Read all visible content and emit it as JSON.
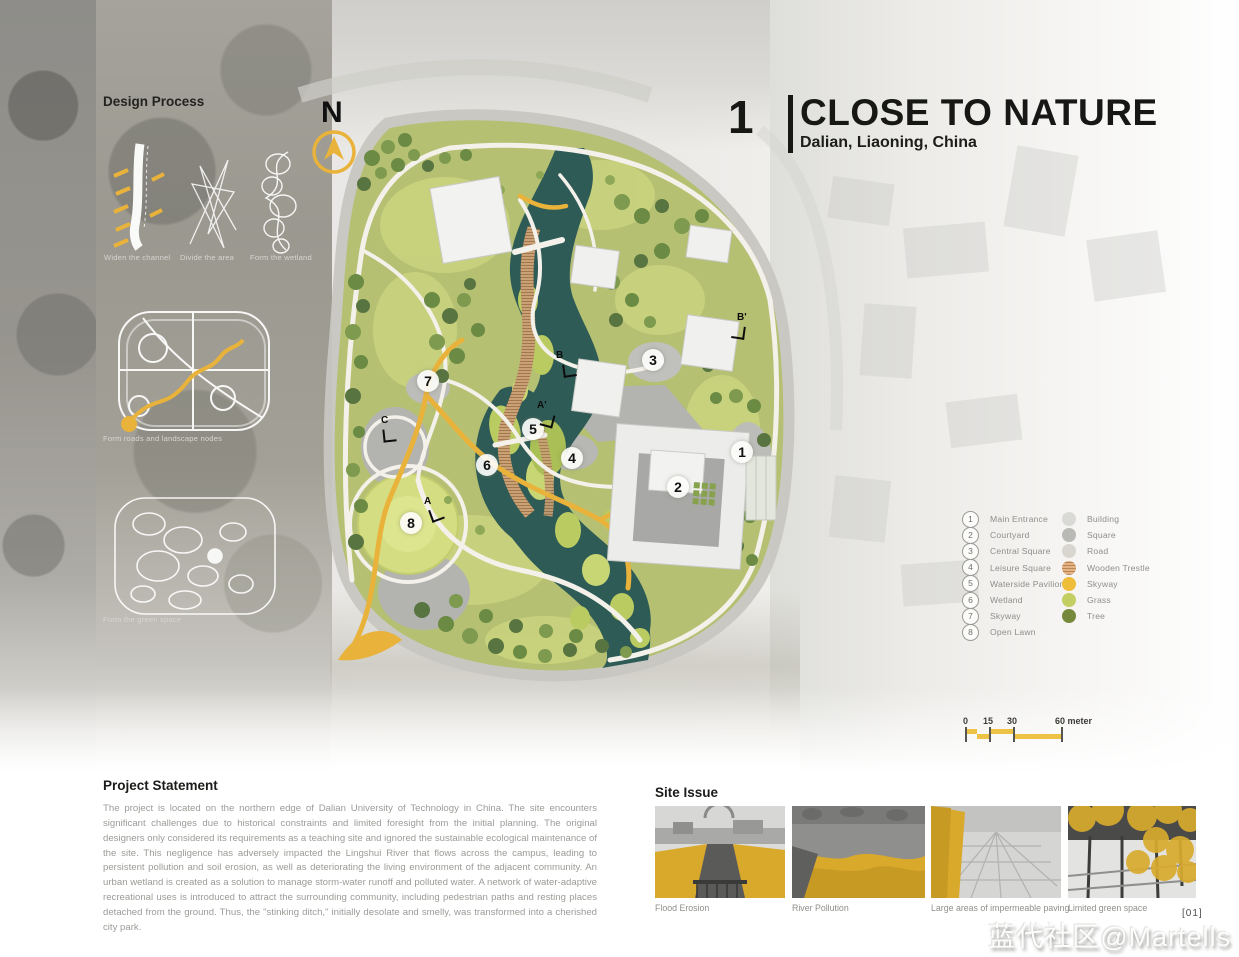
{
  "title_block": {
    "index": "1",
    "title": "CLOSE TO NATURE",
    "subtitle": "Dalian, Liaoning, China"
  },
  "north_label": "N",
  "design_process": {
    "heading": "Design Process",
    "captions": [
      "Widen the channel",
      "Divide the area",
      "Form the wetland",
      "Form roads and landscape nodes",
      "Form the green space"
    ]
  },
  "map": {
    "markers": [
      "1",
      "2",
      "3",
      "4",
      "5",
      "6",
      "7",
      "8"
    ],
    "sections": [
      "B",
      "B'",
      "C",
      "A",
      "A'"
    ]
  },
  "legend": {
    "items": [
      {
        "num": "1",
        "label": "Main Entrance"
      },
      {
        "num": "2",
        "label": "Courtyard"
      },
      {
        "num": "3",
        "label": "Central Square"
      },
      {
        "num": "4",
        "label": "Leisure Square"
      },
      {
        "num": "5",
        "label": "Waterside Pavilion"
      },
      {
        "num": "6",
        "label": "Wetland"
      },
      {
        "num": "7",
        "label": "Skyway"
      },
      {
        "num": "8",
        "label": "Open Lawn"
      }
    ],
    "swatches": [
      {
        "label": "Building",
        "color": "#d9d9d6"
      },
      {
        "label": "Square",
        "color": "#b9b9b6"
      },
      {
        "label": "Road",
        "color": "#d8d6cf"
      },
      {
        "label": "Wooden Trestle",
        "color": "#e5b284"
      },
      {
        "label": "Skyway",
        "color": "#eebe3b"
      },
      {
        "label": "Grass",
        "color": "#c4cf63"
      },
      {
        "label": "Tree",
        "color": "#75883c"
      }
    ]
  },
  "scale_bar": {
    "ticks": [
      "0",
      "15",
      "30",
      "60 meter"
    ]
  },
  "project_statement": {
    "heading": "Project Statement",
    "body": "The project is located on the northern edge of Dalian University of Technology in China. The site encounters significant challenges due to historical constraints and limited foresight from the initial planning. The original designers only considered its requirements as a teaching site and ignored the sustainable ecological maintenance of the site. This negligence has adversely impacted the Lingshui River that flows across the campus, leading to persistent pollution and soil erosion, as well as deteriorating the living environment of the adjacent community. An urban wetland is created as a solution to manage storm-water runoff and polluted water. A network of water-adaptive recreational uses is introduced to attract the surrounding community, including pedestrian paths and resting places detached from the ground. Thus, the \"stinking ditch,\" initially desolate and smelly, was transformed into a cherished city park."
  },
  "site_issue": {
    "heading": "Site Issue",
    "captions": [
      "Flood Erosion",
      "River Pollution",
      "Large areas of impermeable paving",
      "Limited green space"
    ]
  },
  "page_number": "[01]",
  "watermark": "蓝代社区@Martells",
  "accent_color": "#e9b33b"
}
